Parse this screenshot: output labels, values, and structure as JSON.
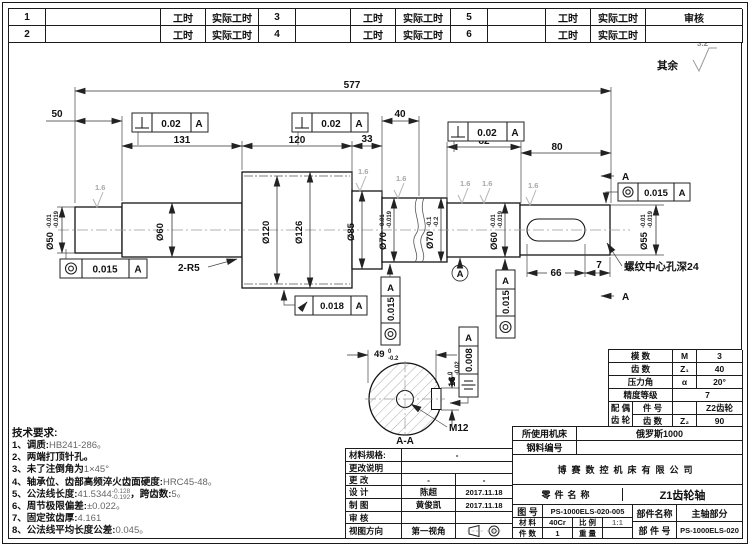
{
  "top_table": {
    "rows": [
      [
        "1",
        "",
        "工时",
        "实际工时",
        "3",
        "",
        "工时",
        "实际工时",
        "5",
        "",
        "工时",
        "实际工时",
        "审核"
      ],
      [
        "2",
        "",
        "工时",
        "实际工时",
        "4",
        "",
        "工时",
        "实际工时",
        "6",
        "",
        "工时",
        "实际工时",
        ""
      ]
    ]
  },
  "corner": {
    "rest_label": "其余",
    "rest_value": "3.2"
  },
  "dims": {
    "overall": "577",
    "len50": "50",
    "len131": "131",
    "len120": "120",
    "len33": "33",
    "len40": "40",
    "len82": "82",
    "len80": "80",
    "len66": "66",
    "len7": "7",
    "flat": "49",
    "flat_up": "0",
    "flat_dn": "-0.2",
    "key": "16",
    "key_up": "0",
    "key_dn": "-0.02"
  },
  "diams": {
    "d50": {
      "v": "Ø50",
      "up": "-0.01",
      "dn": "-0.019"
    },
    "d60": {
      "v": "Ø60"
    },
    "d120": {
      "v": "Ø120"
    },
    "d126": {
      "v": "Ø126"
    },
    "d85": {
      "v": "Ø85"
    },
    "d70a": {
      "v": "Ø70",
      "up": "-0.01",
      "dn": "-0.019"
    },
    "d70b": {
      "v": "Ø70",
      "up": "-0.1",
      "dn": "-0.2"
    },
    "d60b": {
      "v": "Ø60",
      "up": "-0.01",
      "dn": "-0.019"
    },
    "d55": {
      "v": "Ø55",
      "up": "-0.01",
      "dn": "-0.019"
    }
  },
  "fcf": {
    "perp1": {
      "sym": "⊥",
      "val": "0.02",
      "ref": "A"
    },
    "perp2": {
      "sym": "⊥",
      "val": "0.02",
      "ref": "A"
    },
    "perp3": {
      "sym": "⊥",
      "val": "0.02",
      "ref": "A"
    },
    "conc_tr": {
      "sym": "◎",
      "val": "0.015",
      "ref": "A"
    },
    "conc_left": {
      "sym": "◎",
      "val": "0.015",
      "ref": "A"
    },
    "runout": {
      "sym": "↗",
      "val": "0.018",
      "ref": "A"
    },
    "conc_v1": {
      "sym": "◎",
      "val": "0.015",
      "ref": "A"
    },
    "conc_v2": {
      "sym": "◎",
      "val": "0.015",
      "ref": "A"
    },
    "sym_v": {
      "sym": "⌯",
      "val": "0.008",
      "ref": "A"
    }
  },
  "notes": {
    "fillet": "2-R5",
    "thread_note": "螺纹中心孔深24",
    "m12": "M12",
    "section": "A-A",
    "datum": "A",
    "sec_a_top": "A",
    "sec_a_bot": "A",
    "finish": "1.6"
  },
  "tech": {
    "title": "技术要求:",
    "items": [
      {
        "label": "1、调质:",
        "value": "HB241-286。"
      },
      {
        "label": "2、两端打顶针孔。",
        "value": ""
      },
      {
        "label": "3、未了注倒角为",
        "value": "1×45°"
      },
      {
        "label": "4、轴承位、齿部高频淬火齿面硬度:",
        "value": "HRC45-48。"
      },
      {
        "label": "5、公法线长度:",
        "value": "41.5344",
        "sup": "-0.128",
        "sub": "-0.192",
        "label2": "，跨齿数:",
        "value2": "5。"
      },
      {
        "label": "6、周节极限偏差:",
        "value": "±0.022。"
      },
      {
        "label": "7、固定弦齿厚:",
        "value": "4.161"
      },
      {
        "label": "8、公法线平均长度公差:",
        "value": "0.045。"
      }
    ]
  },
  "gear_table": {
    "rows": [
      {
        "label": "模  数",
        "sym": "M",
        "val": "3"
      },
      {
        "label": "齿  数",
        "sym": "Z₁",
        "val": "40"
      },
      {
        "label": "压力角",
        "sym": "α",
        "val": "20°"
      },
      {
        "label": "精度等级",
        "sym": "",
        "val": "7"
      }
    ],
    "pair_label_1": "配 偶",
    "pair_label_2": "齿 轮",
    "pair_rows": [
      {
        "label": "件  号",
        "sym": "",
        "val": "Z2齿轮"
      },
      {
        "label": "齿  数",
        "sym": "Z₂",
        "val": "90"
      }
    ]
  },
  "title_block": {
    "machine_label": "所使用机床",
    "machine_value": "俄罗斯1000",
    "steel_label": "钢料编号",
    "steel_value": "",
    "company": "博赛数控机床有限公司",
    "part_name_label": "零件名称",
    "part_name": "Z1齿轮轴",
    "drawing_no_label": "图 号",
    "drawing_no": "PS-1000ELS-020-005",
    "assembly_name_label": "部件名称",
    "assembly_name": "主轴部分",
    "material_label": "材 料",
    "material": "40Cr",
    "scale_label": "比 例",
    "scale": "1:1",
    "assembly_no_label": "部 件 号",
    "assembly_no": "PS-1000ELS-020",
    "qty_label": "件 数",
    "qty": "1",
    "weight_label": "重 量",
    "weight": "",
    "left": {
      "spec_label": "材料规格:",
      "spec_value": "-",
      "change_note_label": "更改说明",
      "change_note_value": "",
      "change_label": "更  改",
      "change_v1": "-",
      "change_v2": "-",
      "design_label": "设  计",
      "design_name": "陈超",
      "design_date": "2017.11.18",
      "draft_label": "制  图",
      "draft_name": "黄俊凯",
      "draft_date": "2017.11.18",
      "check_label": "审  核",
      "check_name": "",
      "check_date": "",
      "view_label": "视图方向",
      "view_value": "第一视角"
    }
  }
}
